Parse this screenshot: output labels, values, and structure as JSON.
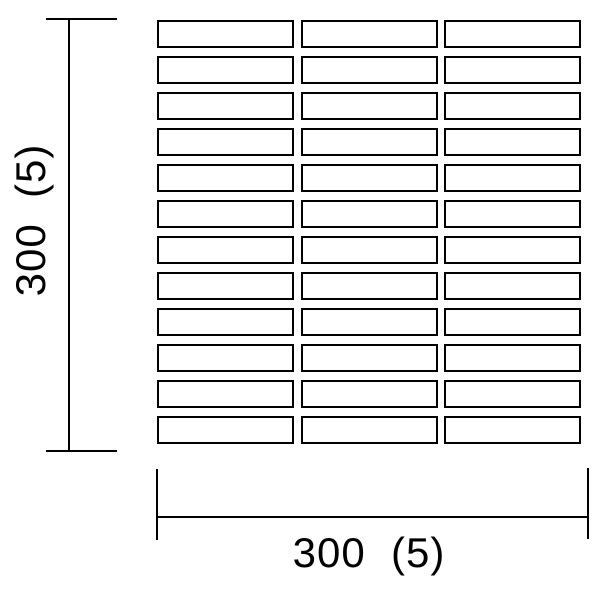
{
  "diagram": {
    "type": "tile-sheet-dimension-drawing",
    "grid": {
      "rows": 12,
      "columns": 3
    },
    "dimensions": {
      "vertical": {
        "label": "300  (5)"
      },
      "horizontal": {
        "label": "300  (5)"
      }
    },
    "colors": {
      "line": "#000000",
      "background": "#ffffff",
      "tile_fill": "#ffffff"
    }
  }
}
